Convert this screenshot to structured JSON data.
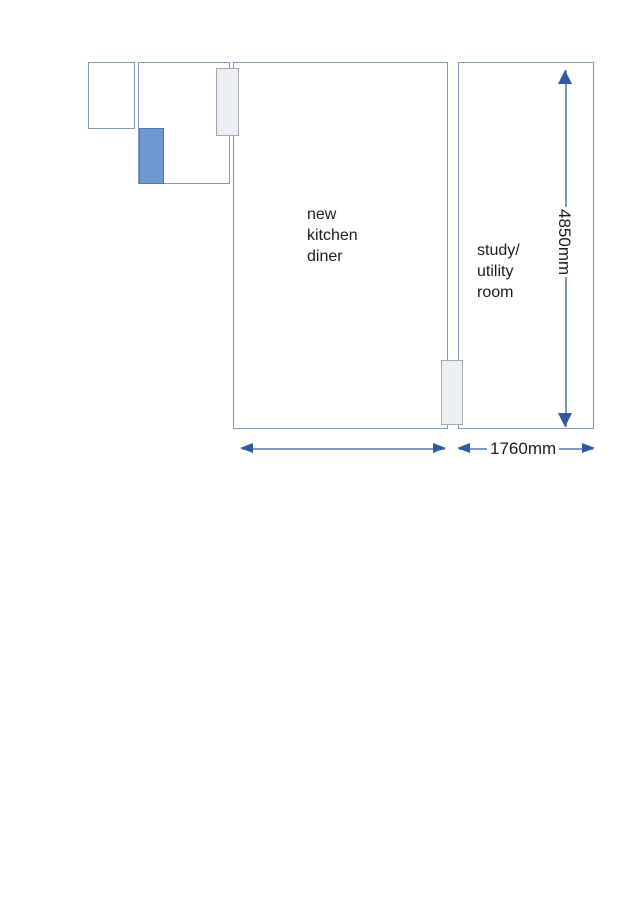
{
  "page": {
    "background": "#ffffff",
    "width": 636,
    "height": 900
  },
  "floorplan": {
    "rooms": [
      {
        "name": "kitchen-diner",
        "label": "new\nkitchen\ndiner"
      },
      {
        "name": "study-utility",
        "label": "study/\nutility\nroom"
      },
      {
        "name": "small-store",
        "label": ""
      },
      {
        "name": "hallway",
        "label": ""
      }
    ],
    "fixtures": [
      {
        "name": "blue-cabinet",
        "fill": "#6f9ad1",
        "border": "#4d7bb0"
      },
      {
        "name": "door-top",
        "fill": "#eceef1",
        "border": "#a2a8b0"
      },
      {
        "name": "door-bottom",
        "fill": "#eceef1",
        "border": "#a2a8b0"
      }
    ],
    "dimensions": {
      "room_height": {
        "value": "4850mm",
        "axis": "vertical"
      },
      "kitchen_width": {
        "value": "",
        "axis": "horizontal"
      },
      "study_width": {
        "value": "1760mm",
        "axis": "horizontal"
      }
    },
    "colors": {
      "wall_line": "#8296bb",
      "arrow_line": "#7d98c4",
      "arrow_head": "#2e5b9e",
      "text": "#1b1b1b"
    }
  }
}
